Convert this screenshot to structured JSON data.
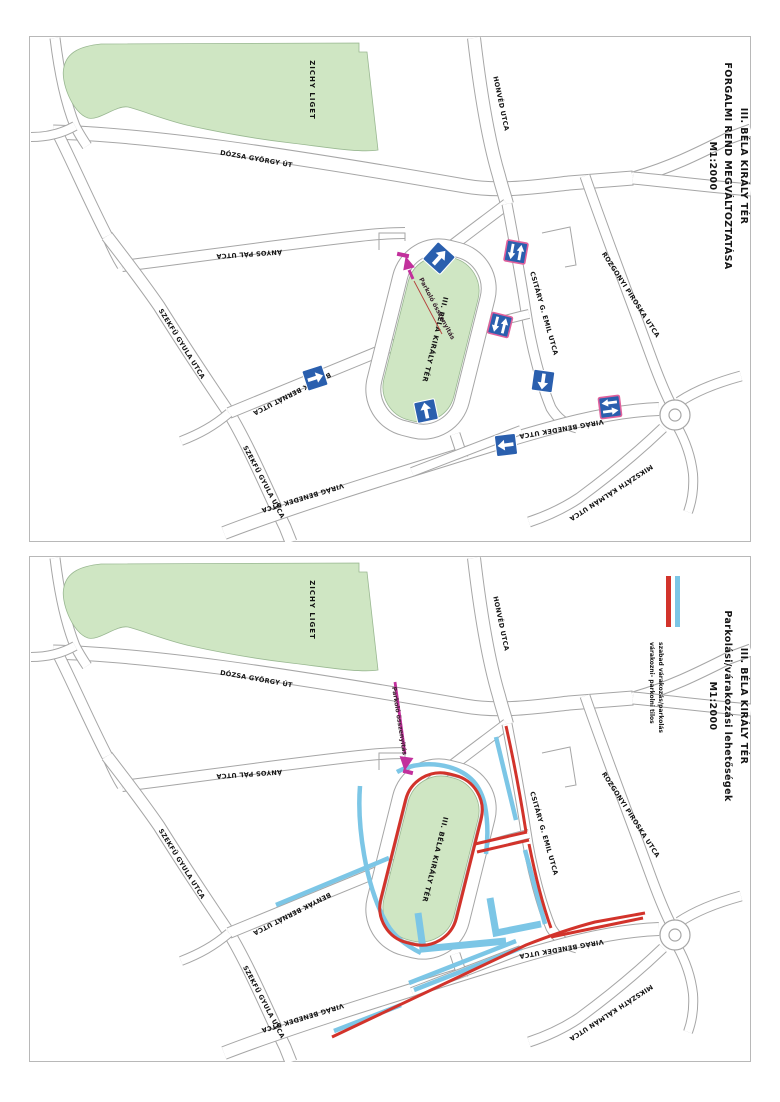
{
  "page": {
    "background": "#ffffff",
    "frame_color": "#b8b8b8"
  },
  "streets": {
    "dozsa_gyorgy_ut": "DÓZSA GYÖRGY ÚT",
    "zichy_liget": "ZICHY LIGET",
    "honved_utca": "HONVÉD UTCA",
    "anyos_pal_utca": "ÁNYOS PÁL UTCA",
    "szekfu_gyula_utca": "SZEKFŰ GYULA UTCA",
    "benyak_bernat_utca": "BENYÁK BERNÁT UTCA",
    "csitary_g_emil_utca": "CSITÁRY G. EMIL UTCA",
    "rozgonyi_piroska_utca": "ROZGONYI PIROSKA UTCA",
    "virag_benedek_utca": "VIRÁG BENEDEK UTCA",
    "mikszath_kalman_utca": "MIKSZÁTH KÁLMÁN UTCA",
    "bela_kiraly_ter": "III. BÉLA KIRÁLY TÉR"
  },
  "top_map": {
    "title_lines": [
      "III. BÉLA KIRÁLY TÉR",
      "FORGALMI REND MEGVÁLTOZTATÁSA",
      "M1:2000"
    ],
    "connector_label": "Parkoló összenyitás",
    "signs": [
      {
        "icon": "one-way-arrow-sign",
        "direction": "northeast"
      },
      {
        "icon": "two-way-traffic-sign",
        "direction": "vertical"
      },
      {
        "icon": "two-way-traffic-sign",
        "direction": "vertical"
      },
      {
        "icon": "one-way-arrow-sign",
        "direction": "down"
      },
      {
        "icon": "two-way-traffic-sign",
        "direction": "horizontal"
      },
      {
        "icon": "one-way-arrow-sign",
        "direction": "up"
      },
      {
        "icon": "one-way-arrow-sign",
        "direction": "left"
      },
      {
        "icon": "one-way-arrow-sign",
        "direction": "right"
      }
    ]
  },
  "bottom_map": {
    "title_lines": [
      "III. BÉLA KIRÁLY TÉR",
      "Parkolási/várakozási lehetőségek",
      "M1:2000"
    ],
    "connector_label": "Parkoló összenyitás",
    "legend": [
      {
        "color": "#7cc6e6",
        "label": "szabad várakozás/parkolás"
      },
      {
        "color": "#d2332b",
        "label": "várakozni- parkolni tilos"
      }
    ]
  },
  "colors": {
    "park_green": "#cfe6c3",
    "road_casing": "#a6a6a6",
    "sign_blue": "#2a5fae",
    "sign_border_pink": "#e0609c",
    "parking_free_blue": "#7cc6e6",
    "parking_forbidden_red": "#d2332b",
    "connector_magenta": "#c2309c"
  }
}
